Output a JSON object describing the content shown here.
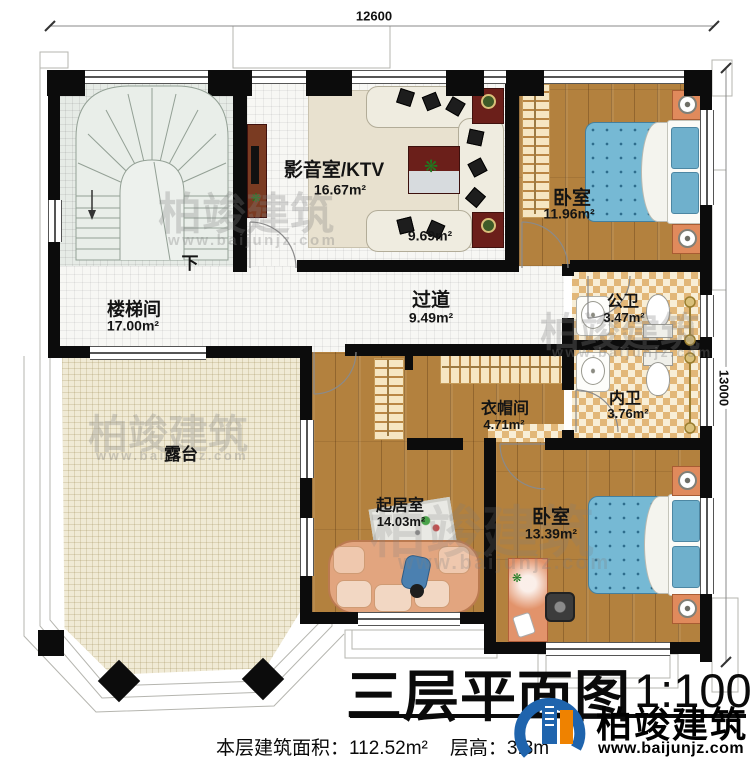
{
  "plan": {
    "dimensions": {
      "width": "12600",
      "height": "13000"
    },
    "stair_direction": "下",
    "rooms": {
      "media": {
        "name": "影音室/KTV",
        "area": "16.67m²"
      },
      "media_seating_area": "9.69m²",
      "bedroom_top": {
        "name": "卧室",
        "area": "11.96m²"
      },
      "public_bath": {
        "name": "公卫",
        "area": "3.47m²"
      },
      "private_bath": {
        "name": "内卫",
        "area": "3.76m²"
      },
      "cloakroom": {
        "name": "衣帽间",
        "area": "4.71m²"
      },
      "stair_hall": {
        "name": "楼梯间",
        "area": "17.00m²"
      },
      "corridor": {
        "name": "过道",
        "area": "9.49m²"
      },
      "terrace": {
        "name": "露台"
      },
      "living": {
        "name": "起居室",
        "area": "14.03m²"
      },
      "bedroom_bottom": {
        "name": "卧室",
        "area": "13.39m²"
      }
    }
  },
  "titleblock": {
    "title": "三层平面图",
    "scale": "1:100",
    "area_label": "本层建筑面积：",
    "area_value": "112.52m²",
    "height_label": "层高：",
    "height_value": "3.3m"
  },
  "branding": {
    "name": "柏竣建筑",
    "url": "www.baijunjz.com"
  },
  "watermark": {
    "text": "柏竣建筑",
    "url": "www.baijunjz.com"
  },
  "colors": {
    "wall": "#0c0c0c",
    "wood": "#b3813e",
    "bed": "#76b9d4",
    "checker": "#e2b778",
    "terrace": "#f0ead5",
    "logo_blue": "#1f64ad",
    "logo_orange": "#ef8200"
  }
}
